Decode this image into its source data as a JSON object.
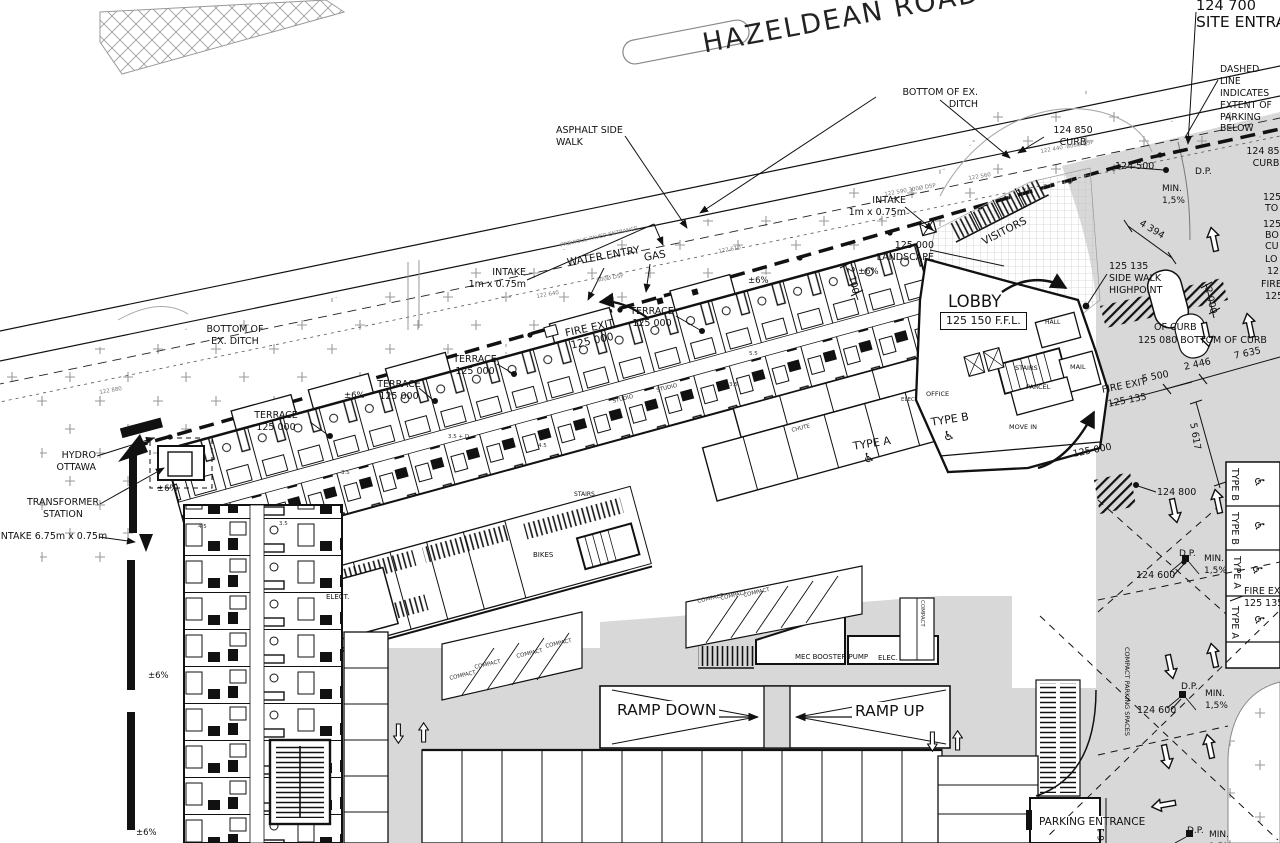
{
  "road": {
    "name": "HAZELDEAN ROAD"
  },
  "site": {
    "entrance_elev": "124 700",
    "entrance": "SITE ENTRANCE",
    "dashed_note": "DASHED LINE\nINDICATES\nEXTENT OF\nPARKING BELOW",
    "bottom_ditch": "BOTTOM OF EX.\nDITCH",
    "bottom_ditch_left": "BOTTOM OF\nEX. DITCH",
    "asphalt": "ASPHALT SIDE\nWALK",
    "curb_124850": "124 850\nCURB",
    "elev_124500": "124 500",
    "elev_124800": "124 800",
    "elev_124600": "124 600",
    "elev_125000": "125 000",
    "elev_125135": "125 135",
    "dp": "D.P.",
    "min_slope": "MIN.\n1,5%",
    "pm6": "±6%",
    "intake_small": "INTAKE\n1m x 0.75m",
    "intake_large": "INTAKE 6.75m x 0.75m",
    "visitors": "VISITORS",
    "landscape": "125 000\nLANDSCAPE",
    "highpoint": "125 135\nSIDE WALK\nHIGHPOINT",
    "water_entry": "WATER ENTRY",
    "gas": "GAS",
    "prev_entrance": "PREVIOUS PAVED ENTRANCE",
    "hydro": "HYDRO\nOTTAWA",
    "transformer": "TRANSFORMER\nSTATION",
    "terrace": "TERRACE\n125 000",
    "fire_exit_125000": "FIRE EXIT\n125 000",
    "fire_exit": "FIRE EXIT",
    "of_curb": "OF CURB",
    "bottom_of_curb": "125 080\nBOTTOM OF CURB",
    "fire_exit_right": "FIRE EXIT\n125 135",
    "parking_entrance": "PARKING\nENTRANCE",
    "compact_spaces": "COMPACT PARKING SPACES"
  },
  "building": {
    "lobby": "LOBBY",
    "ffl": "125 150 F.F.L.",
    "hall": "HALL",
    "stairs": "STAIRS",
    "mail": "MAIL",
    "parcel": "PARCEL",
    "office": "OFFICE",
    "elec": "ELEC.",
    "chute": "CHUTE",
    "move_in": "MOVE IN",
    "elect": "ELECT.",
    "bikes": "BIKES",
    "studio": "STUDIO",
    "u35": "3.5",
    "u45": "4.5",
    "u55": "5.5",
    "u35d": "3.5 + D"
  },
  "garage": {
    "ramp_down": "RAMP DOWN",
    "ramp_up": "RAMP UP",
    "compact": "COMPACT",
    "mec": "MEC BOOSTER PUMP",
    "elec": "ELEC.",
    "type_a": "TYPE A",
    "type_b": "TYPE B"
  },
  "dims": {
    "d4394": "4 394",
    "d2100": "2 100",
    "d2000": "2 000",
    "d2446": "2 446",
    "d7635": "7 635",
    "d5617": "5 617",
    "d5500": "5 500",
    "d6100": "6 100"
  },
  "survey": {
    "s1": "122 440 -800Ø DSP",
    "s2": "122 560",
    "s3": "122 590 300Ø DSP",
    "s4": "122 610",
    "s5": "600Ø DSP",
    "s6": "122 640",
    "s7": "122 880"
  },
  "edge_fragments": {
    "f1": "125",
    "f2": "TO",
    "f3": "125",
    "f4": "BO",
    "f5": "CU",
    "f6": "LO",
    "f7": "12",
    "f8": "FIRE",
    "f9": "125"
  },
  "icons": {
    "accessible": "♿"
  },
  "colors": {
    "line": "#111111",
    "aisle_gray": "#d8d8d8",
    "survey_gray": "#777777"
  }
}
